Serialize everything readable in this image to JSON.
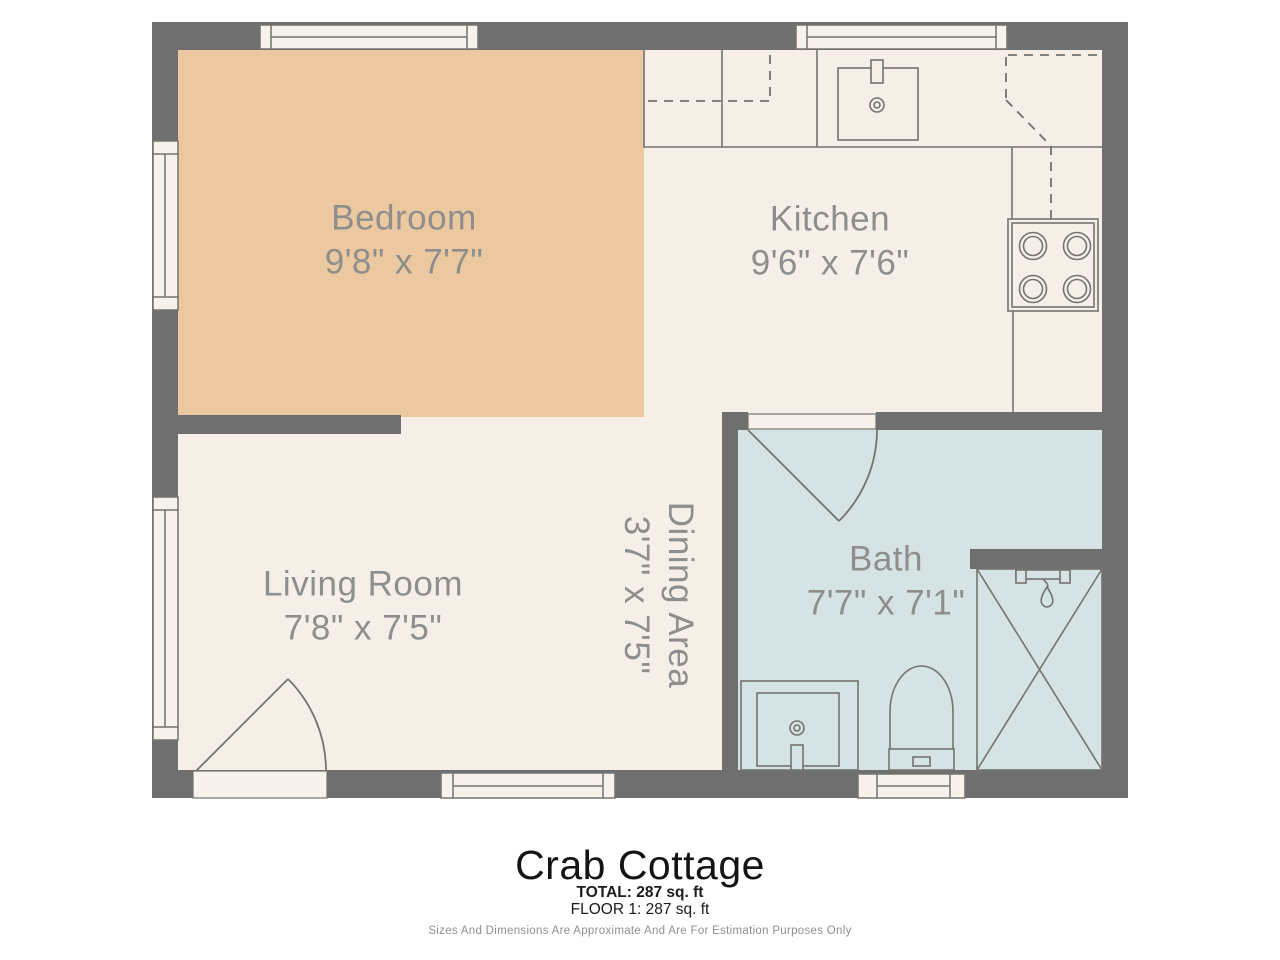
{
  "document_type": "floor-plan",
  "colors": {
    "wall": "#6f6f6f",
    "floor": "#f6efe8",
    "bedroom_floor": "#ecc8a1",
    "bath_floor": "#d6e3e4",
    "line": "#73736f",
    "window_fill": "#f8f2ec",
    "label": "#8e8e8c",
    "title": "#141414",
    "footnote": "#8f8f8f"
  },
  "rooms": [
    {
      "id": "bedroom",
      "name": "Bedroom",
      "dimensions": "9'8\" x 7'7\""
    },
    {
      "id": "kitchen",
      "name": "Kitchen",
      "dimensions": "9'6\" x 7'6\""
    },
    {
      "id": "living",
      "name": "Living Room",
      "dimensions": "7'8\" x 7'5\""
    },
    {
      "id": "dining",
      "name": "Dining Area",
      "dimensions": "3'7\" x 7'5\""
    },
    {
      "id": "bath",
      "name": "Bath",
      "dimensions": "7'7\" x 7'1\""
    }
  ],
  "fixtures": [
    "kitchen-sink",
    "stove-4-burner",
    "bath-vanity-sink",
    "toilet",
    "shower",
    "entry-door",
    "bath-door"
  ],
  "windows_count": 6,
  "footer": {
    "title": "Crab Cottage",
    "total": "TOTAL: 287 sq. ft",
    "floor": "FLOOR 1: 287 sq. ft",
    "disclaimer": "Sizes And Dimensions Are Approximate And Are For Estimation Purposes Only"
  }
}
